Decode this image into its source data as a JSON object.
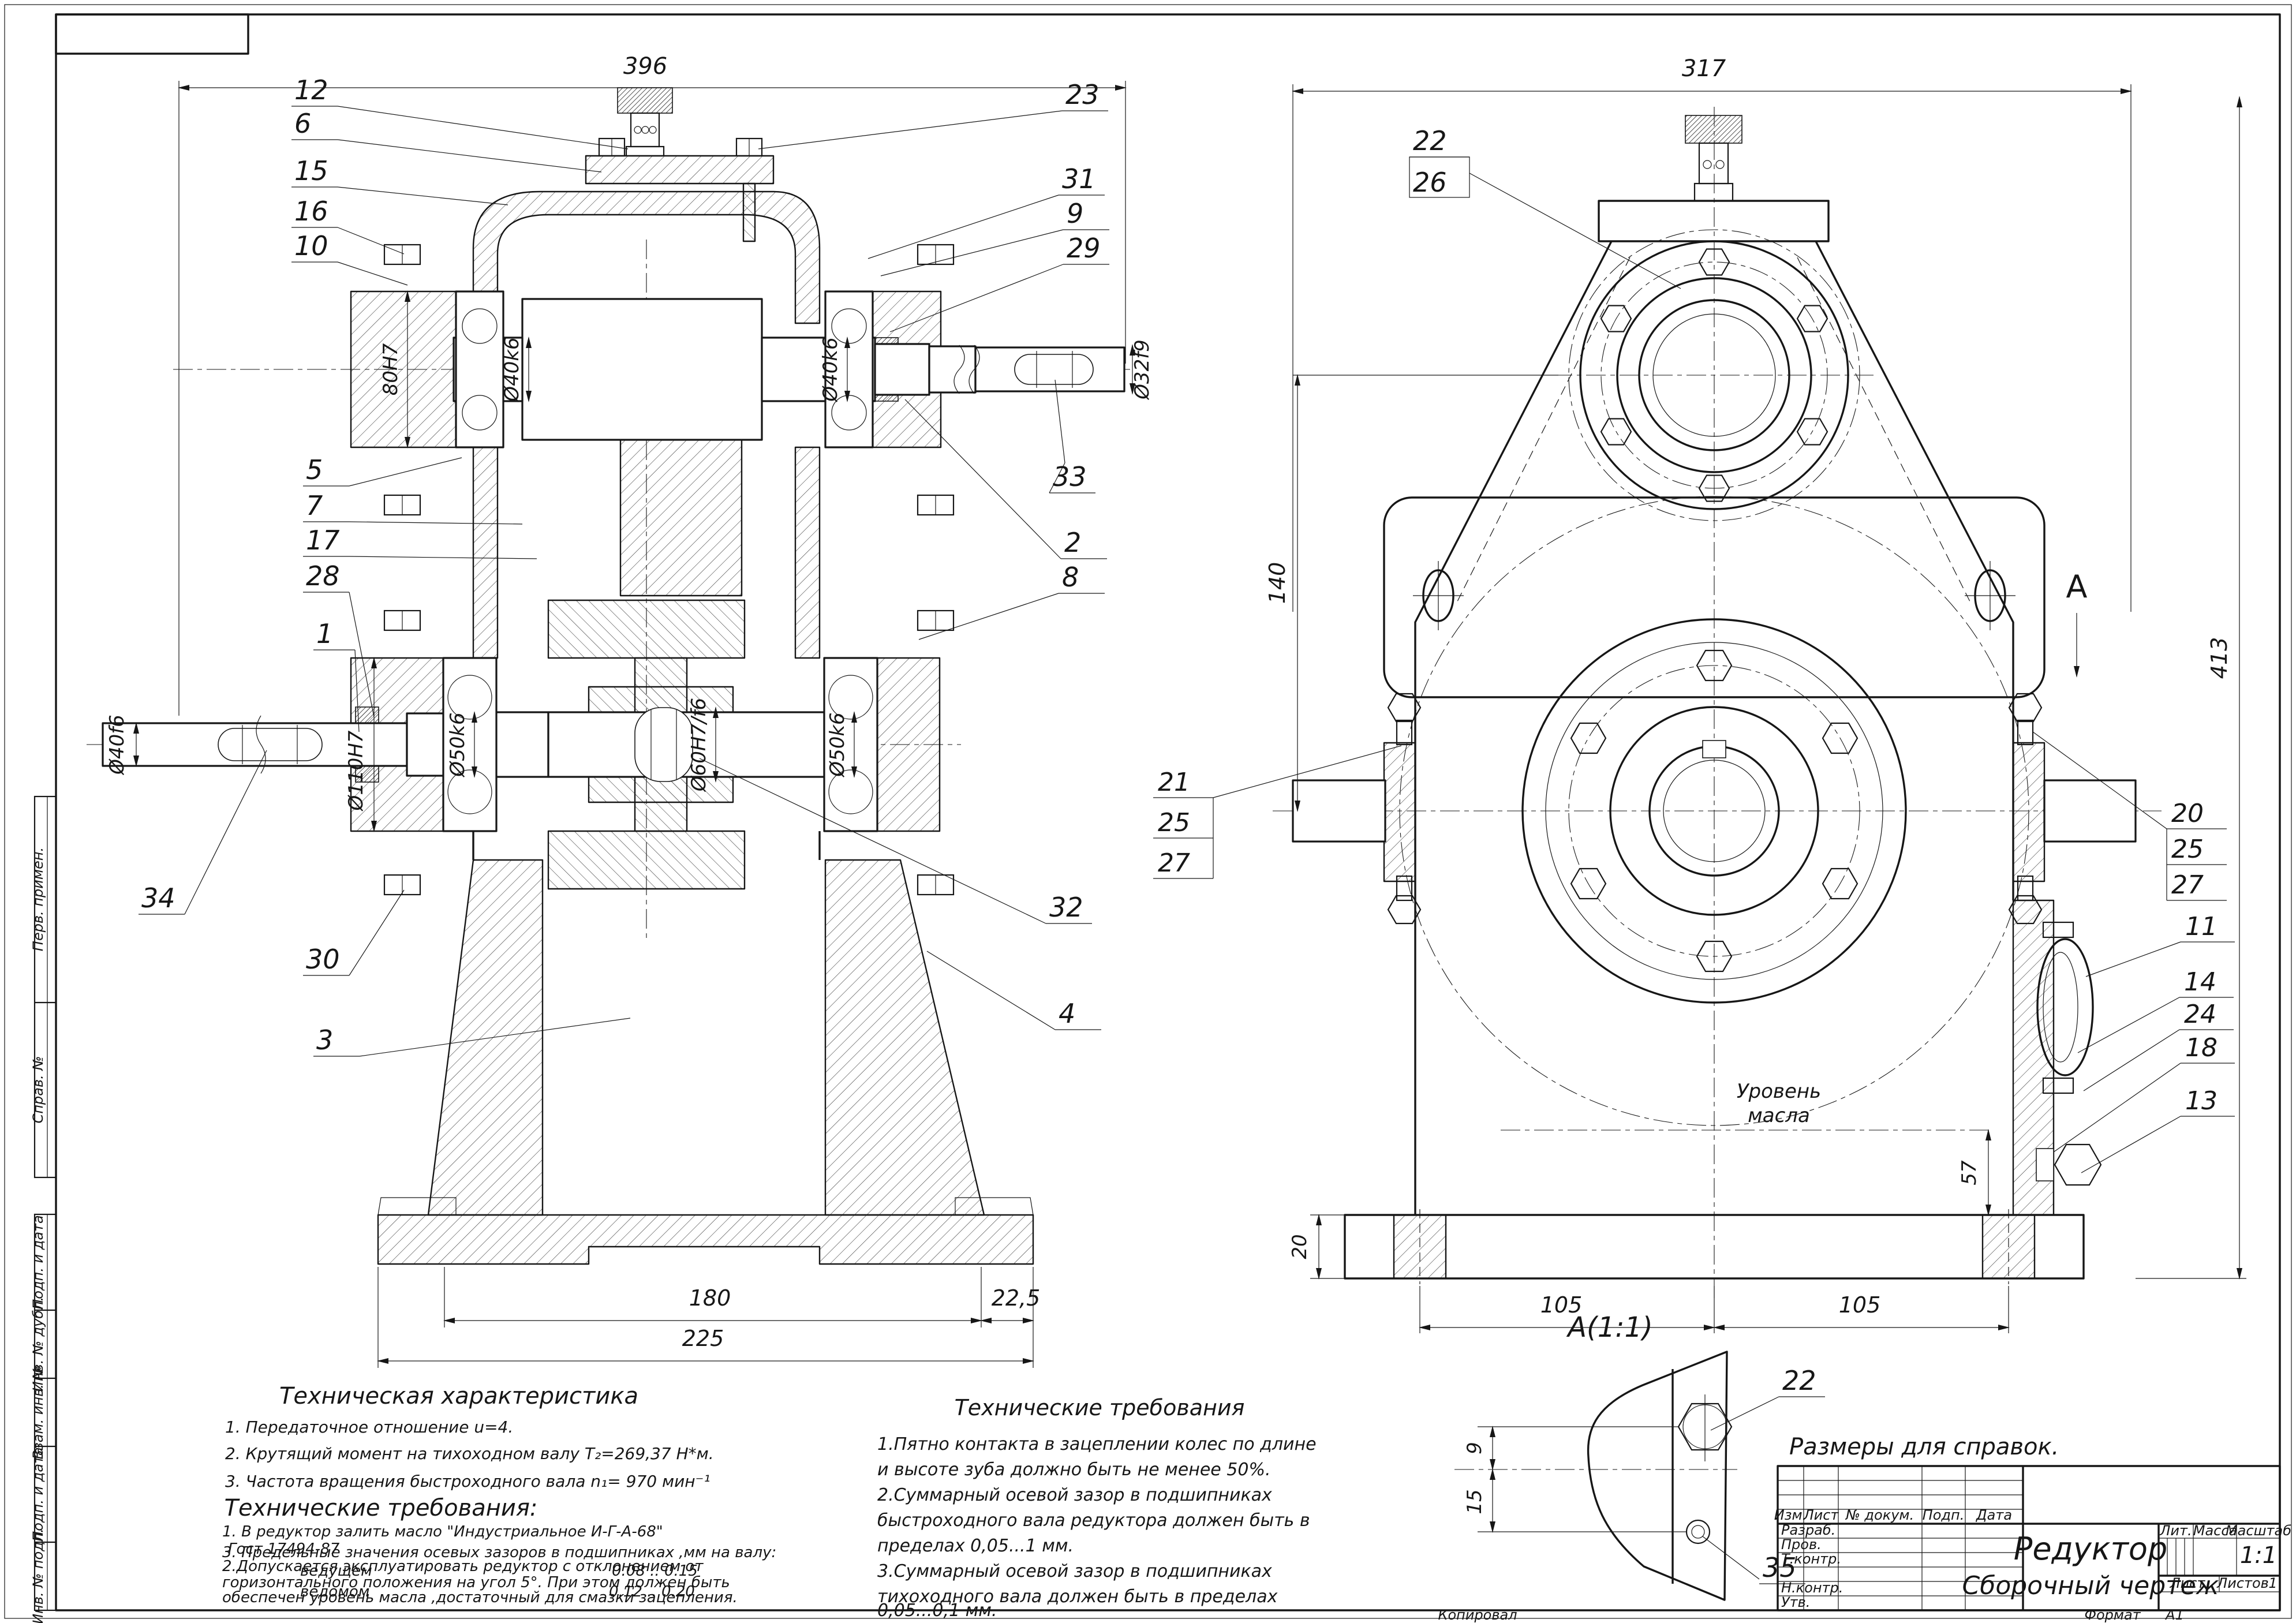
{
  "sheet": {
    "kopiroval": "Копировал",
    "format_label": "Формат",
    "format_value": "А1"
  },
  "frame": {
    "stamps": [
      "Перв. примен.",
      "Справ. №",
      "Подп. и дата",
      "Инв. № дубл.",
      "Взам. инв. №",
      "Подп. и дата",
      "Инв. № подл."
    ]
  },
  "front": {
    "dim_width": "396",
    "dim_bore": "80H7",
    "dim_d40k6": "Ø40k6",
    "dim_d32f9": "Ø32f9",
    "dim_d40f6": "Ø40f6",
    "dim_d110": "Ø110H7",
    "dim_d50k6": "Ø50k6",
    "dim_d60": "Ø60H7/f6",
    "dim_180": "180",
    "dim_22_5": "22,5",
    "dim_225": "225"
  },
  "side": {
    "dim_width": "317",
    "dim_height": "413",
    "dim_140": "140",
    "dim_57": "57",
    "dim_20": "20",
    "dim_105": "105",
    "oil_line1": "Уровень",
    "oil_line2": "масла",
    "view_arrow": "A"
  },
  "detail": {
    "title": "А(1:1)",
    "dim_9": "9",
    "dim_15": "15"
  },
  "callouts": {
    "n1": "1",
    "n2": "2",
    "n3": "3",
    "n4": "4",
    "n5": "5",
    "n6": "6",
    "n7": "7",
    "n8": "8",
    "n9": "9",
    "n10": "10",
    "n11": "11",
    "n12": "12",
    "n13": "13",
    "n14": "14",
    "n15": "15",
    "n16": "16",
    "n17": "17",
    "n18": "18",
    "n20": "20",
    "n21": "21",
    "n22": "22",
    "n23": "23",
    "n24": "24",
    "n25": "25",
    "n26": "26",
    "n27": "27",
    "n28": "28",
    "n29": "29",
    "n30": "30",
    "n31": "31",
    "n32": "32",
    "n33": "33",
    "n34": "34",
    "n35": "35"
  },
  "tech_char": {
    "title": "Техническая характеристика",
    "line1": "1. Передаточное отношение u=4.",
    "line2": "2. Крутящий момент на тихоходном валу Т₂=269,37 Н*м.",
    "line3": "3. Частота вращения быстроходного вала n₁= 970 мин⁻¹"
  },
  "tech_req": {
    "title": "Технические  требования:",
    "line1": "1. В редуктор залить масло \"Индустриальное И-Г-А-68\"",
    "line2": "Гост 17494-87",
    "line3": "2.Допускается эксплуатировать редуктор с отклонением от",
    "line4": "горизонтального положения на угол 5°. При этом должен быть",
    "line5": "обеспечен уровень масла ,достаточный для смазки зацепления.",
    "line6": "3. Предельные значения осевых зазоров в подшипниках ,мм на валу:",
    "line7a": "ведущем",
    "line7b": "0.08 .. 0.15",
    "line8a": "ведомом",
    "line8b": "0.12 .. 0.20"
  },
  "tech_req_center": {
    "title": "Технические требования",
    "line1": "1.Пятно контакта в зацеплении колес по длине",
    "line2": "и высоте зуба должно быть не менее 50%.",
    "line3": "2.Суммарный осевой зазор в подшипниках",
    "line4": "быстроходного вала редуктора должен быть в",
    "line5": "пределах 0,05...1 мм.",
    "line6": "3.Суммарный осевой зазор в подшипниках",
    "line7": "тихоходного вала должен быть в пределах",
    "line8": "0,05...0,1 мм."
  },
  "note": "Размеры для справок.",
  "title_block": {
    "name": "Редуктор",
    "doc_type": "Сборочный чертеж",
    "izm": "Изм.",
    "list": "Лист",
    "doc": "№ докум.",
    "podp": "Подп.",
    "data": "Дата",
    "razrab": "Разраб.",
    "prov": "Пров.",
    "tkontr": "Т.контр.",
    "nkontr": "Н.контр.",
    "utv": "Утв.",
    "lit": "Лит.",
    "massa": "Масса",
    "masshtab": "Масштаб",
    "scale": "1:1",
    "list_label": "Лист",
    "listov_label": "Листов",
    "listov_value": "1"
  }
}
